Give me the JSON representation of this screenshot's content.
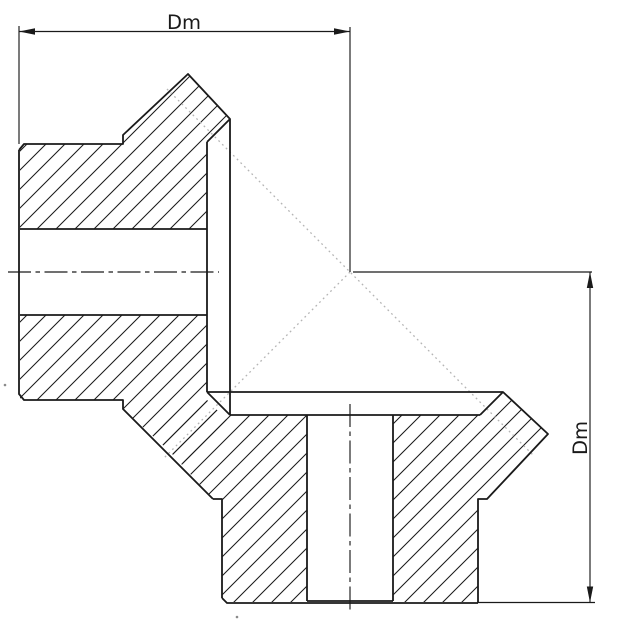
{
  "drawing": {
    "labels": {
      "top": "Dm",
      "right": "Dm"
    },
    "colors": {
      "outline": "#1a1a1a",
      "thin_line": "#1a1a1a",
      "pitch_line": "#b5b5b5",
      "text": "#1a1a1a",
      "background": "#ffffff"
    }
  }
}
